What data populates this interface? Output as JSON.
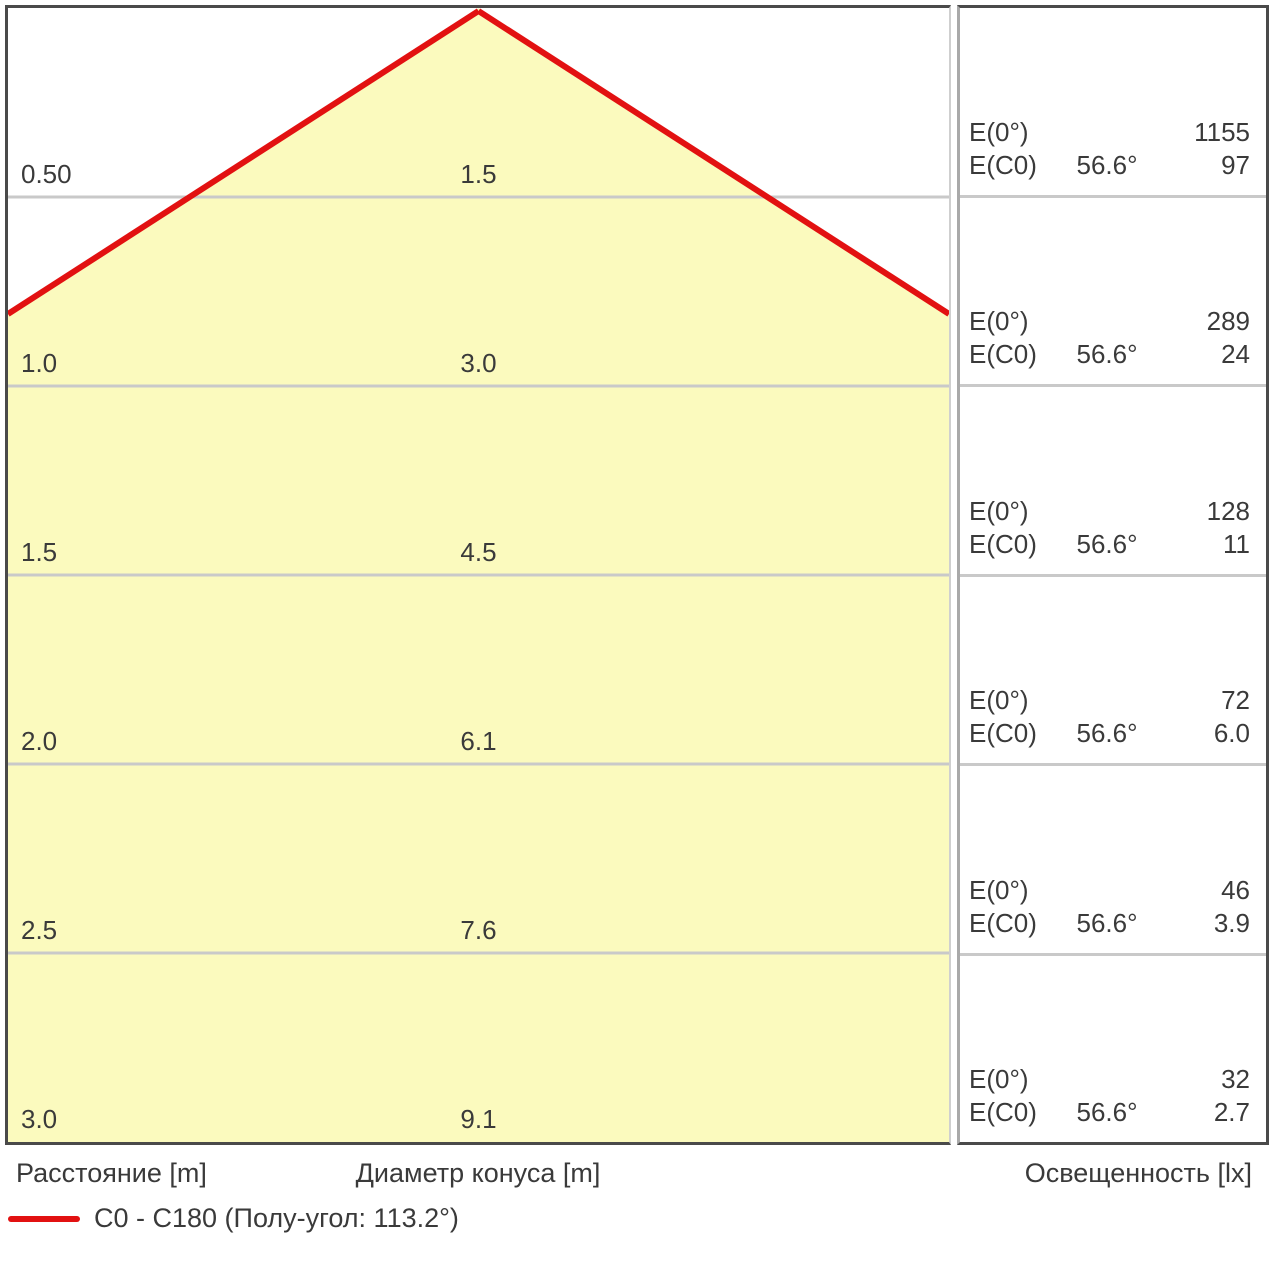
{
  "colors": {
    "cone_fill": "#FBFABE",
    "cone_line": "#E21111",
    "grid_line": "#C9C9C9",
    "panel_border": "#4A4A4A",
    "text": "#3A3A3A"
  },
  "labels": {
    "e0": "E(0°)",
    "ec0": "E(C0)"
  },
  "footer": {
    "distance": "Расстояние [m]",
    "diameter": "Диаметр конуса [m]",
    "illuminance": "Освещенность [lx]"
  },
  "legend": {
    "label": "C0 - C180 (Полу-угол: 113.2°)"
  },
  "chart_data": {
    "type": "line",
    "title": "Photometric cone diagram (light cone)",
    "y_label": "Расстояние [m]",
    "x_label": "Диаметр конуса [m]",
    "value_label": "Освещенность [lx]",
    "c_plane": "C0 - C180",
    "half_beam_angle": "113.2°",
    "half_angle_per_side": "56.6°",
    "distances_m": [
      0.5,
      1.0,
      1.5,
      2.0,
      2.5,
      3.0
    ],
    "cone_diameters_m": [
      1.5,
      3.0,
      4.5,
      6.1,
      7.6,
      9.1
    ],
    "E0_lx": [
      1155,
      289,
      128,
      72,
      46,
      32
    ],
    "EC0_lx": [
      97,
      24,
      11,
      6.0,
      3.9,
      2.7
    ],
    "rows": [
      {
        "distance": "0.50",
        "diameter": "1.5",
        "e0": "1155",
        "angle": "56.6°",
        "ec0": "97"
      },
      {
        "distance": "1.0",
        "diameter": "3.0",
        "e0": "289",
        "angle": "56.6°",
        "ec0": "24"
      },
      {
        "distance": "1.5",
        "diameter": "4.5",
        "e0": "128",
        "angle": "56.6°",
        "ec0": "11"
      },
      {
        "distance": "2.0",
        "diameter": "6.1",
        "e0": "72",
        "angle": "56.6°",
        "ec0": "6.0"
      },
      {
        "distance": "2.5",
        "diameter": "7.6",
        "e0": "46",
        "angle": "56.6°",
        "ec0": "3.9"
      },
      {
        "distance": "3.0",
        "diameter": "9.1",
        "e0": "32",
        "angle": "56.6°",
        "ec0": "2.7"
      }
    ]
  }
}
